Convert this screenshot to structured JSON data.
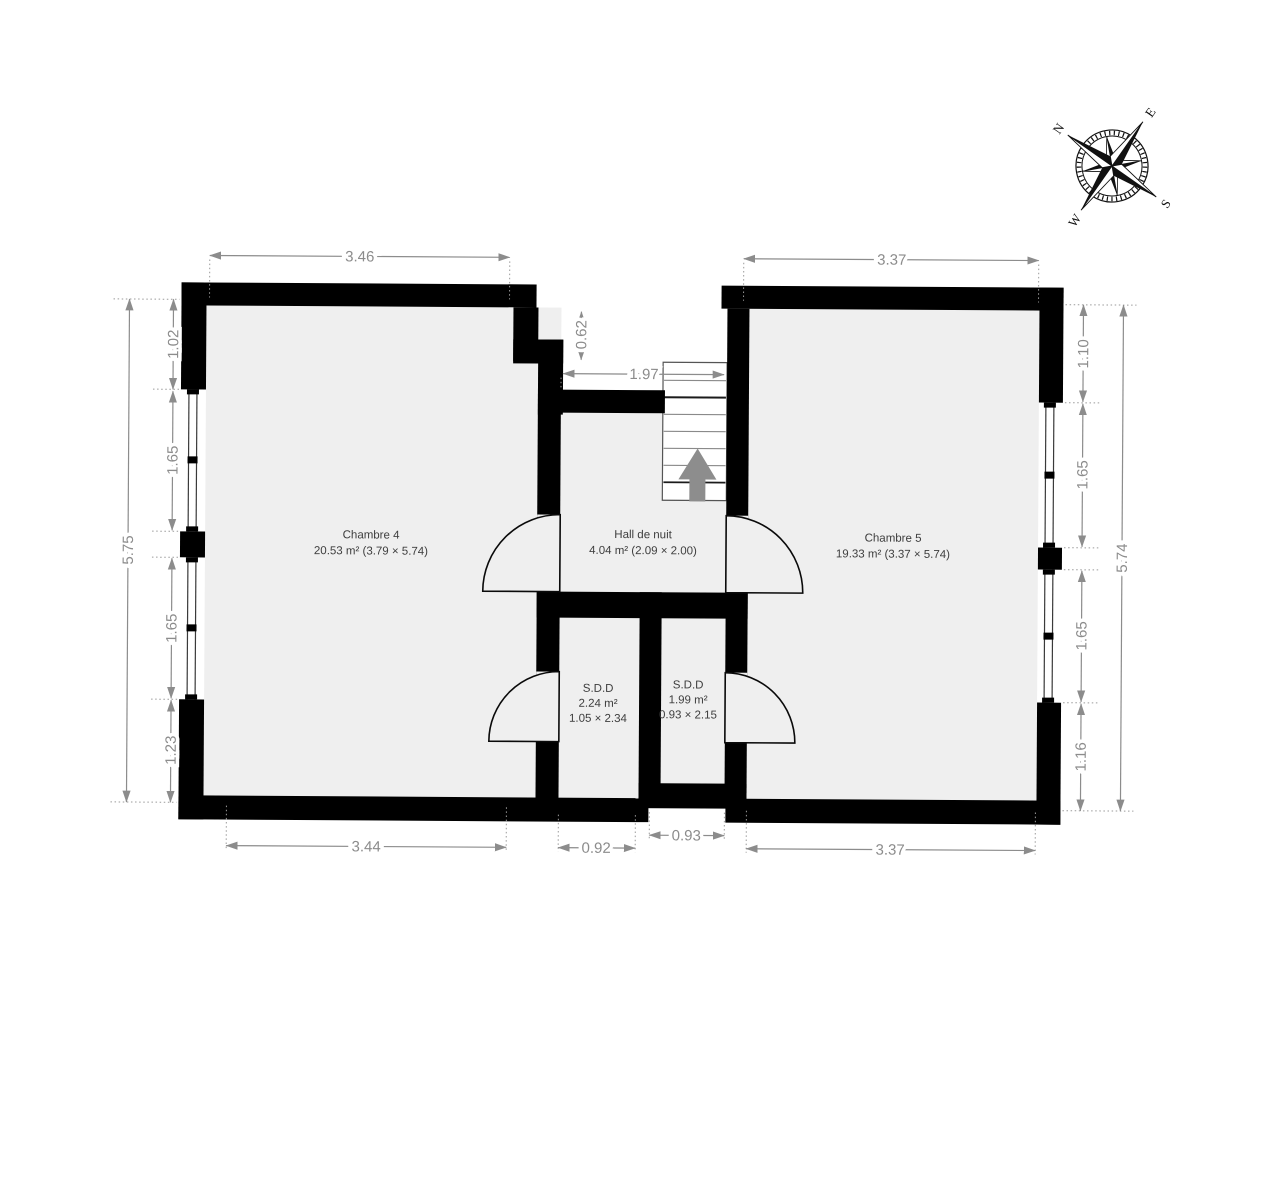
{
  "plan": {
    "rooms": {
      "chambre4": {
        "name": "Chambre 4",
        "area": "20.53 m² (3.79 × 5.74)"
      },
      "hall": {
        "name": "Hall de nuit",
        "area": "4.04 m² (2.09 × 2.00)"
      },
      "chambre5": {
        "name": "Chambre 5",
        "area": "19.33 m² (3.37 × 5.74)"
      },
      "sdd1": {
        "name": "S.D.D",
        "area": "2.24 m²",
        "size": "1.05 × 2.34"
      },
      "sdd2": {
        "name": "S.D.D",
        "area": "1.99 m²",
        "size": "0.93 × 2.15"
      }
    },
    "dimensions": {
      "top_left": "3.46",
      "top_right": "3.37",
      "left_total": "5.75",
      "left_segments": [
        "1.02",
        "1.65",
        "1.65",
        "1.23"
      ],
      "right_total": "5.74",
      "right_segments": [
        "1.10",
        "1.65",
        "1.65",
        "1.16"
      ],
      "step": "0.62",
      "hall_width": "1.97",
      "bottom_left": "3.44",
      "bottom_sdd1": "0.92",
      "bottom_sdd2": "0.93",
      "bottom_right": "3.37"
    },
    "compass": {
      "n": "N",
      "e": "E",
      "s": "S",
      "w": "W"
    },
    "colors": {
      "wall": "#000000",
      "floor": "#efefef",
      "dimension": "#8c8c8c",
      "room_text": "#3d3d3d",
      "stair_arrow": "#8d8d8d"
    }
  }
}
